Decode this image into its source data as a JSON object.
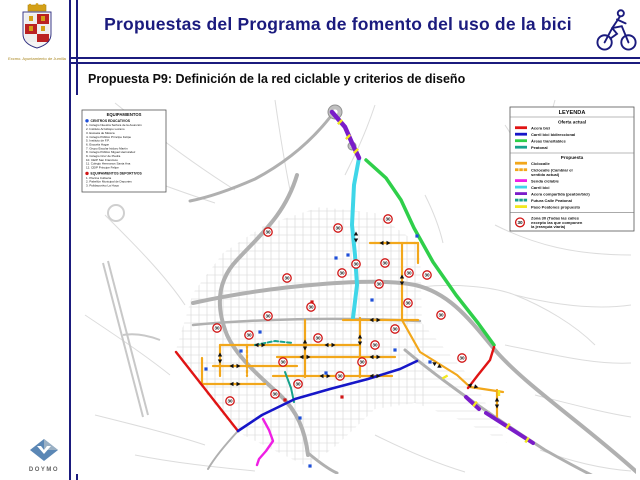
{
  "header": {
    "title": "Propuestas del Programa de fomento del uso de la bici",
    "logo_caption": "Excmo. Ayuntamiento de Jumilla"
  },
  "subtitle": "Propuesta P9: Definición de la red ciclable y criterios de diseño",
  "footer": {
    "logo_text": "DOYMO"
  },
  "equipamientos": {
    "title": "EQUIPAMIENTOS",
    "sections": [
      {
        "label": "CENTROS EDUCATIVOS",
        "bullet_color": "#1f4fd8",
        "items": [
          "Colegio Nuestra Señora de la Asunción",
          "Instituto Arzobispo Lozano",
          "Escuela de Música",
          "Colegio Público Príncipe Felipe",
          "Instituto de F.P.",
          "Escuela Hogar",
          "Grupo Escolar Isidoro Martín",
          "Colegio Público Miguel Hernández",
          "Colegio Cruz de Piedra",
          "CEIP San Francisco",
          "Colegio Hermanos Santa Ana",
          "CEIP Príncipe Felipe"
        ]
      },
      {
        "label": "EQUIPAMIENTOS DEPORTIVOS",
        "bullet_color": "#d01616",
        "items": [
          "Piscina Cubierta",
          "Pabellón Municipal de Deportes",
          "Polideportivo La Hoya"
        ]
      }
    ]
  },
  "legend": {
    "title": "LEYENDA",
    "sections": [
      {
        "label": "Oferta actual",
        "items": [
          {
            "label": "Acera bici",
            "color": "#e01414",
            "dash": null
          },
          {
            "label": "Carril bici bidireccional",
            "color": "#1616c8",
            "dash": null
          },
          {
            "label": "Áreas transitables",
            "color": "#2fcf4a",
            "dash": null
          },
          {
            "label": "Peatonal",
            "color": "#17a28c",
            "dash": null
          }
        ]
      },
      {
        "label": "Propuesta",
        "items": [
          {
            "label": "Ciclocalle",
            "color": "#f2a71b",
            "dash": null
          },
          {
            "label": "Ciclocalle (Cambiar el\nsentido actual)",
            "color": "#f2a71b",
            "dash": "3 2"
          },
          {
            "label": "Senda ciclable",
            "color": "#ef1fe4",
            "dash": null
          },
          {
            "label": "Carril bici",
            "color": "#3fd6e8",
            "dash": null
          },
          {
            "label": "Acera compartida (peatón/bici)",
            "color": "#7a1cc9",
            "dash": null
          },
          {
            "label": "Futura Calle Peatonal",
            "color": "#17a28c",
            "dash": "3 2"
          },
          {
            "label": "Paso Peatones propuesto",
            "color": "#f2e81f",
            "dash": null
          }
        ]
      }
    ],
    "zona30": {
      "label": "Zona 30 (Todas las calles\nexcepto las que componen\nla jerarquía viaria)",
      "badge": "30",
      "badge_color": "#d01414"
    }
  },
  "map": {
    "zona30_badge_text": "30",
    "zona30_color": "#d01414",
    "routes": [
      {
        "name": "areas-transitables-este",
        "color": "#2fcf4a",
        "width": 3.5,
        "points": [
          [
            291,
            65
          ],
          [
            311,
            83
          ],
          [
            326,
            105
          ],
          [
            339,
            133
          ],
          [
            358,
            167
          ],
          [
            381,
            200
          ],
          [
            403,
            228
          ],
          [
            419,
            250
          ]
        ]
      },
      {
        "name": "carril-bici-norte",
        "color": "#3fd6e8",
        "width": 4,
        "points": [
          [
            284,
            63
          ],
          [
            279,
            90
          ],
          [
            277,
            130
          ],
          [
            280,
            160
          ],
          [
            282,
            190
          ],
          [
            278,
            223
          ]
        ]
      },
      {
        "name": "acera-compartida-norte",
        "color": "#7a1cc9",
        "width": 4.5,
        "points": [
          [
            257,
            17
          ],
          [
            270,
            32
          ],
          [
            277,
            48
          ],
          [
            284,
            63
          ]
        ]
      },
      {
        "name": "ciclocalle-1",
        "color": "#f2a71b",
        "width": 2.2,
        "points": [
          [
            295,
            148
          ],
          [
            343,
            148
          ]
        ]
      },
      {
        "name": "ciclocalle-2",
        "color": "#f2a71b",
        "width": 2.2,
        "points": [
          [
            327,
            148
          ],
          [
            327,
            225
          ]
        ]
      },
      {
        "name": "ciclocalle-3",
        "color": "#f2a71b",
        "width": 2.2,
        "points": [
          [
            343,
            148
          ],
          [
            343,
            168
          ]
        ]
      },
      {
        "name": "ciclocalle-4",
        "color": "#f2a71b",
        "width": 2.2,
        "points": [
          [
            268,
            225
          ],
          [
            343,
            225
          ]
        ]
      },
      {
        "name": "ciclocalle-5",
        "color": "#f2a71b",
        "width": 2.2,
        "points": [
          [
            327,
            225
          ],
          [
            345,
            257
          ],
          [
            382,
            280
          ],
          [
            395,
            292
          ],
          [
            428,
            297
          ]
        ]
      },
      {
        "name": "ciclocalle-6",
        "color": "#f2a71b",
        "width": 2.2,
        "points": [
          [
            422,
            295
          ],
          [
            422,
            322
          ]
        ]
      },
      {
        "name": "ciclocalle-7",
        "color": "#f2a71b",
        "width": 2.2,
        "points": [
          [
            145,
            250
          ],
          [
            285,
            250
          ]
        ]
      },
      {
        "name": "ciclocalle-8",
        "color": "#f2a71b",
        "width": 2.2,
        "points": [
          [
            202,
            262
          ],
          [
            320,
            262
          ]
        ]
      },
      {
        "name": "ciclocalle-9",
        "color": "#f2a71b",
        "width": 2.2,
        "points": [
          [
            138,
            271
          ],
          [
            222,
            271
          ]
        ]
      },
      {
        "name": "ciclocalle-10",
        "color": "#f2a71b",
        "width": 2.2,
        "points": [
          [
            198,
            281
          ],
          [
            317,
            281
          ]
        ]
      },
      {
        "name": "ciclocalle-11",
        "color": "#f2a71b",
        "width": 2.2,
        "points": [
          [
            145,
            250
          ],
          [
            145,
            281
          ]
        ]
      },
      {
        "name": "ciclocalle-12",
        "color": "#f2a71b",
        "width": 2.2,
        "points": [
          [
            230,
            225
          ],
          [
            230,
            282
          ]
        ]
      },
      {
        "name": "ciclocalle-13",
        "color": "#f2a71b",
        "width": 2.2,
        "points": [
          [
            285,
            223
          ],
          [
            285,
            282
          ]
        ]
      },
      {
        "name": "ciclocalle-14",
        "color": "#f2a71b",
        "width": 2.2,
        "points": [
          [
            127,
            263
          ],
          [
            127,
            289
          ],
          [
            190,
            289
          ]
        ]
      },
      {
        "name": "ciclocalle-cambio-sentido",
        "color": "#f2a71b",
        "width": 2.2,
        "dash": "3 2",
        "points": [
          [
            172,
            250
          ],
          [
            172,
            281
          ]
        ]
      },
      {
        "name": "futura-calle-peatonal",
        "color": "#17a28c",
        "width": 2,
        "dash": "4 2.5",
        "points": [
          [
            180,
            250
          ],
          [
            200,
            246
          ],
          [
            218,
            248
          ]
        ]
      },
      {
        "name": "peatonal-existente",
        "color": "#17a28c",
        "width": 2,
        "points": [
          [
            210,
            277
          ],
          [
            216,
            293
          ],
          [
            219,
            307
          ]
        ]
      },
      {
        "name": "acera-bici-oeste",
        "color": "#e01414",
        "width": 2.4,
        "points": [
          [
            101,
            257
          ],
          [
            163,
            336
          ]
        ]
      },
      {
        "name": "acera-bici-este",
        "color": "#e01414",
        "width": 2.4,
        "points": [
          [
            419,
            252
          ],
          [
            415,
            265
          ],
          [
            403,
            280
          ],
          [
            393,
            293
          ]
        ]
      },
      {
        "name": "carril-bici-bidireccional-sur",
        "color": "#1616c8",
        "width": 2.6,
        "points": [
          [
            163,
            336
          ],
          [
            187,
            320
          ],
          [
            220,
            304
          ],
          [
            255,
            294
          ],
          [
            293,
            284
          ],
          [
            325,
            274
          ],
          [
            342,
            266
          ]
        ]
      },
      {
        "name": "senda-ciclable-sur",
        "color": "#ef1fe4",
        "width": 2.4,
        "points": [
          [
            188,
            324
          ],
          [
            194,
            335
          ],
          [
            198,
            346
          ],
          [
            191,
            356
          ],
          [
            184,
            364
          ],
          [
            182,
            370
          ]
        ]
      },
      {
        "name": "acera-compartida-sureste-1",
        "color": "#7a1cc9",
        "width": 4,
        "points": [
          [
            391,
            302
          ],
          [
            404,
            314
          ]
        ]
      },
      {
        "name": "acera-compartida-sureste-2",
        "color": "#7a1cc9",
        "width": 4,
        "points": [
          [
            411,
            318
          ],
          [
            458,
            348
          ]
        ]
      }
    ],
    "badges": [
      [
        263,
        133
      ],
      [
        313,
        124
      ],
      [
        193,
        137
      ],
      [
        212,
        183
      ],
      [
        267,
        178
      ],
      [
        310,
        168
      ],
      [
        304,
        189
      ],
      [
        333,
        208
      ],
      [
        142,
        233
      ],
      [
        193,
        221
      ],
      [
        243,
        243
      ],
      [
        208,
        267
      ],
      [
        223,
        289
      ],
      [
        265,
        281
      ],
      [
        287,
        267
      ],
      [
        300,
        250
      ],
      [
        320,
        234
      ],
      [
        281,
        169
      ],
      [
        334,
        178
      ],
      [
        352,
        180
      ],
      [
        366,
        220
      ],
      [
        387,
        263
      ],
      [
        155,
        306
      ],
      [
        200,
        299
      ],
      [
        236,
        212
      ],
      [
        174,
        240
      ]
    ],
    "education_points": [
      [
        273,
        160
      ],
      [
        342,
        141
      ],
      [
        166,
        256
      ],
      [
        131,
        274
      ],
      [
        251,
        278
      ],
      [
        235,
        371
      ],
      [
        185,
        237
      ],
      [
        225,
        323
      ],
      [
        320,
        255
      ],
      [
        355,
        267
      ],
      [
        297,
        205
      ],
      [
        261,
        163
      ]
    ],
    "sports_points": [
      [
        210,
        305
      ],
      [
        267,
        302
      ],
      [
        237,
        207
      ]
    ],
    "arrows": [
      [
        185,
        250,
        0
      ],
      [
        255,
        250,
        0
      ],
      [
        230,
        262,
        0
      ],
      [
        300,
        262,
        0
      ],
      [
        160,
        271,
        0
      ],
      [
        250,
        281,
        0
      ],
      [
        300,
        281,
        0
      ],
      [
        310,
        148,
        0
      ],
      [
        300,
        225,
        0
      ],
      [
        327,
        185,
        90
      ],
      [
        230,
        250,
        90
      ],
      [
        285,
        245,
        90
      ],
      [
        145,
        263,
        90
      ],
      [
        281,
        142,
        90
      ],
      [
        362,
        270,
        30
      ],
      [
        398,
        291,
        15
      ],
      [
        160,
        289,
        0
      ],
      [
        422,
        308,
        90
      ]
    ],
    "crosswalks": [
      [
        265,
        27,
        45
      ],
      [
        273,
        42,
        45
      ],
      [
        281,
        56,
        45
      ],
      [
        400,
        309,
        38
      ],
      [
        433,
        331,
        33
      ],
      [
        452,
        345,
        33
      ],
      [
        424,
        298,
        0
      ],
      [
        370,
        282,
        60
      ]
    ]
  }
}
